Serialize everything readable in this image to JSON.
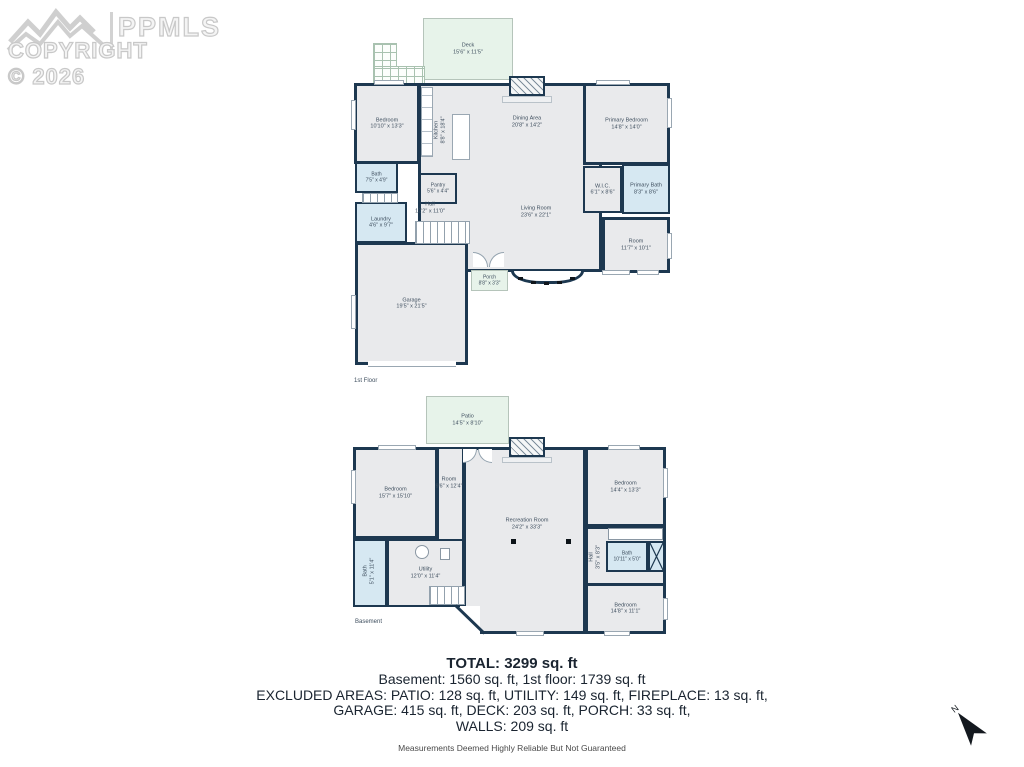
{
  "watermark": {
    "brand": "PPMLS",
    "copyright": "COPYRIGHT © 2026"
  },
  "floor1": {
    "label": "1st Floor",
    "deck": {
      "name": "Deck",
      "dims": "15'6\" x 11'5\""
    },
    "bedroom": {
      "name": "Bedroom",
      "dims": "10'10\" x 13'3\""
    },
    "kitchen": {
      "name": "Kitchen",
      "dims": "8'8\" x 18'4\""
    },
    "dining": {
      "name": "Dining Area",
      "dims": "20'8\" x 14'2\""
    },
    "primary_bedroom": {
      "name": "Primary Bedroom",
      "dims": "14'8\" x 14'0\""
    },
    "bath": {
      "name": "Bath",
      "dims": "7'5\" x 4'9\""
    },
    "pantry": {
      "name": "Pantry",
      "dims": "5'6\" x 4'4\""
    },
    "hall": {
      "name": "Hall",
      "dims": "12'2\" x 11'0\""
    },
    "laundry": {
      "name": "Laundry",
      "dims": "4'6\" x 9'7\""
    },
    "wic": {
      "name": "W.I.C.",
      "dims": "6'1\" x 8'6\""
    },
    "primary_bath": {
      "name": "Primary Bath",
      "dims": "8'3\" x 8'6\""
    },
    "living": {
      "name": "Living Room",
      "dims": "23'6\" x 22'1\""
    },
    "room": {
      "name": "Room",
      "dims": "11'7\" x 10'1\""
    },
    "garage": {
      "name": "Garage",
      "dims": "19'5\" x 21'5\""
    },
    "porch": {
      "name": "Porch",
      "dims": "8'8\" x 3'3\""
    }
  },
  "basement": {
    "label": "Basement",
    "patio": {
      "name": "Patio",
      "dims": "14'5\" x 8'10\""
    },
    "bedroom_left": {
      "name": "Bedroom",
      "dims": "15'7\" x 15'10\""
    },
    "room": {
      "name": "Room",
      "dims": "9'6\" x 12'4\""
    },
    "recreation": {
      "name": "Recreation Room",
      "dims": "24'2\" x 33'3\""
    },
    "bedroom_right": {
      "name": "Bedroom",
      "dims": "14'4\" x 13'3\""
    },
    "bath_left": {
      "name": "Bath",
      "dims": "5'1\" x 11'4\""
    },
    "utility": {
      "name": "Utility",
      "dims": "12'0\" x 11'4\""
    },
    "hall": {
      "name": "Hall",
      "dims": "3'5\" x 8'3\""
    },
    "bath_right": {
      "name": "Bath",
      "dims": "10'11\" x 5'0\""
    },
    "bedroom_bottom": {
      "name": "Bedroom",
      "dims": "14'8\" x 11'1\""
    }
  },
  "summary": {
    "total": "TOTAL: 3299 sq. ft",
    "floors_line": "Basement: 1560 sq. ft, 1st floor: 1739 sq. ft",
    "excluded_line1": "EXCLUDED AREAS: PATIO: 128 sq. ft, UTILITY: 149 sq. ft, FIREPLACE: 13 sq. ft,",
    "excluded_line2": "GARAGE: 415 sq. ft, DECK: 203 sq. ft, PORCH: 33 sq. ft,",
    "excluded_line3": "WALLS: 209 sq. ft",
    "disclaimer": "Measurements Deemed Highly Reliable But Not Guaranteed"
  },
  "compass": {
    "label": "N"
  },
  "colors": {
    "wall": "#1d3850",
    "room_fill": "#e9eaec",
    "wet_fill": "#d6e8f2",
    "outdoor_fill": "#e7f3ea"
  }
}
